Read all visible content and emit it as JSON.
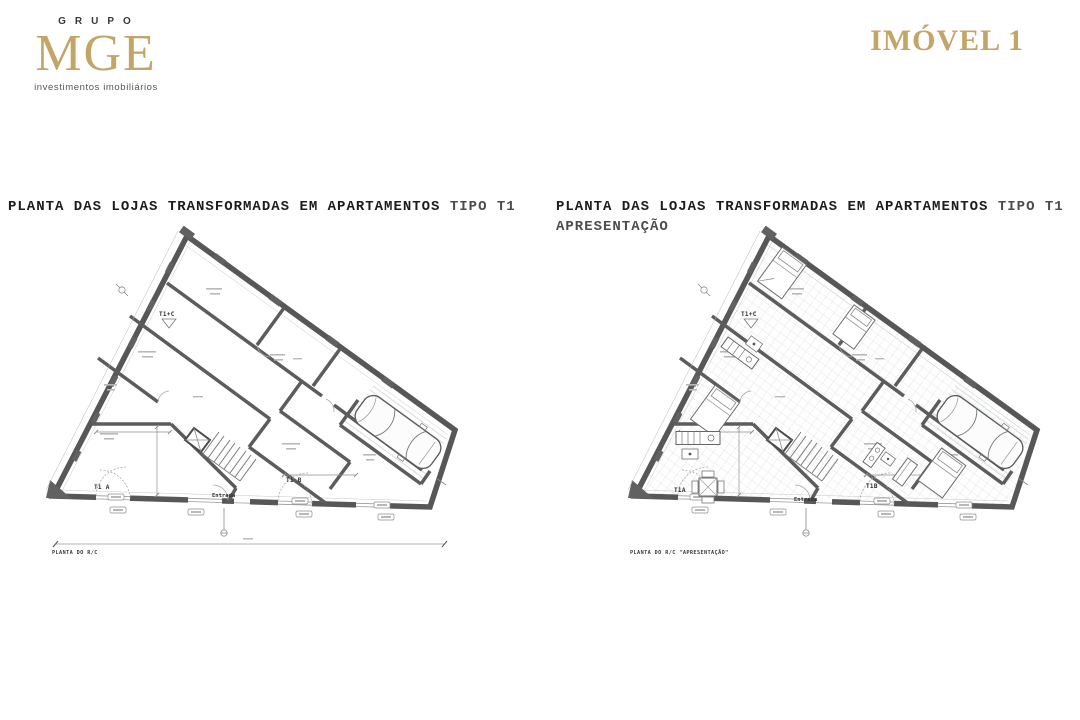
{
  "logo": {
    "grupo": "GRUPO",
    "mge": "MGE",
    "subtitle": "investimentos imobiliários"
  },
  "header": {
    "title": "IMÓVEL 1"
  },
  "plans": {
    "left": {
      "title_main": "PLANTA DAS LOJAS TRANSFORMADAS EM APARTAMENTOS",
      "title_suffix": "TIPO T1",
      "caption": "PLANTA DO R/C",
      "labels": {
        "t1c": "T1+C",
        "t1a": "T1 A",
        "t1b": "T1 B",
        "entrada": "Entrada"
      }
    },
    "right": {
      "title_main": "PLANTA DAS LOJAS TRANSFORMADAS EM APARTAMENTOS",
      "title_suffix": "TIPO T1",
      "title_line2": "APRESENTAÇÃO",
      "caption": "PLANTA DO R/C \"APRESENTAÇÃO\"",
      "labels": {
        "t1c": "T1+C",
        "t1a": "T1A",
        "t1b": "T1B",
        "entrada": "Entrada"
      }
    }
  },
  "theme": {
    "brand_gold": "#C3A566",
    "wall_gray": "#5C5C5C",
    "background": "#FFFFFF"
  }
}
